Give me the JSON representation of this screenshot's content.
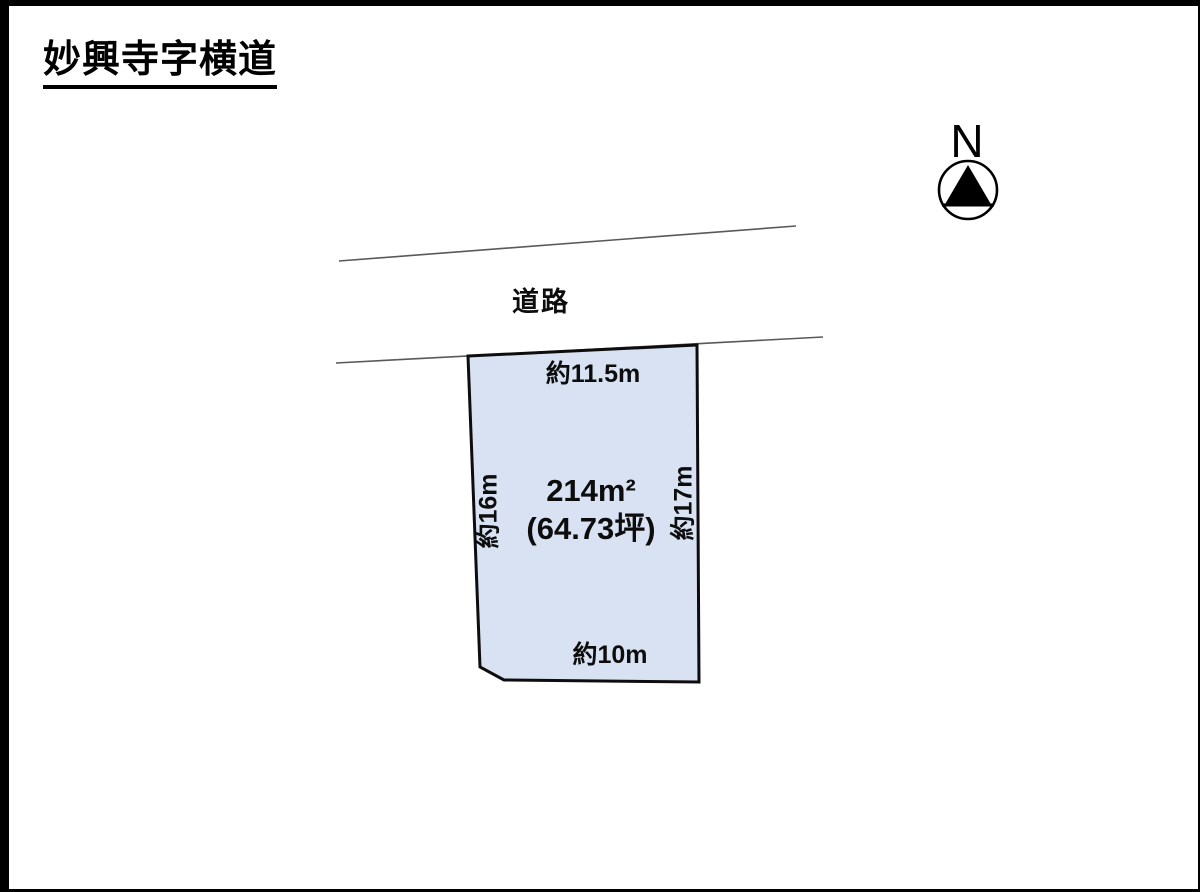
{
  "page": {
    "title": "妙興寺字横道"
  },
  "compass": {
    "label": "N"
  },
  "road": {
    "label": "道路"
  },
  "plot": {
    "area_sqm": "214m²",
    "area_tsubo": "(64.73坪)",
    "dim_top": "約11.5m",
    "dim_left": "約16m",
    "dim_right": "約17m",
    "dim_bottom": "約10m",
    "fill_color": "#d9e2f3",
    "outline_color": "#0d0d0d",
    "road_line_color": "#595959"
  }
}
